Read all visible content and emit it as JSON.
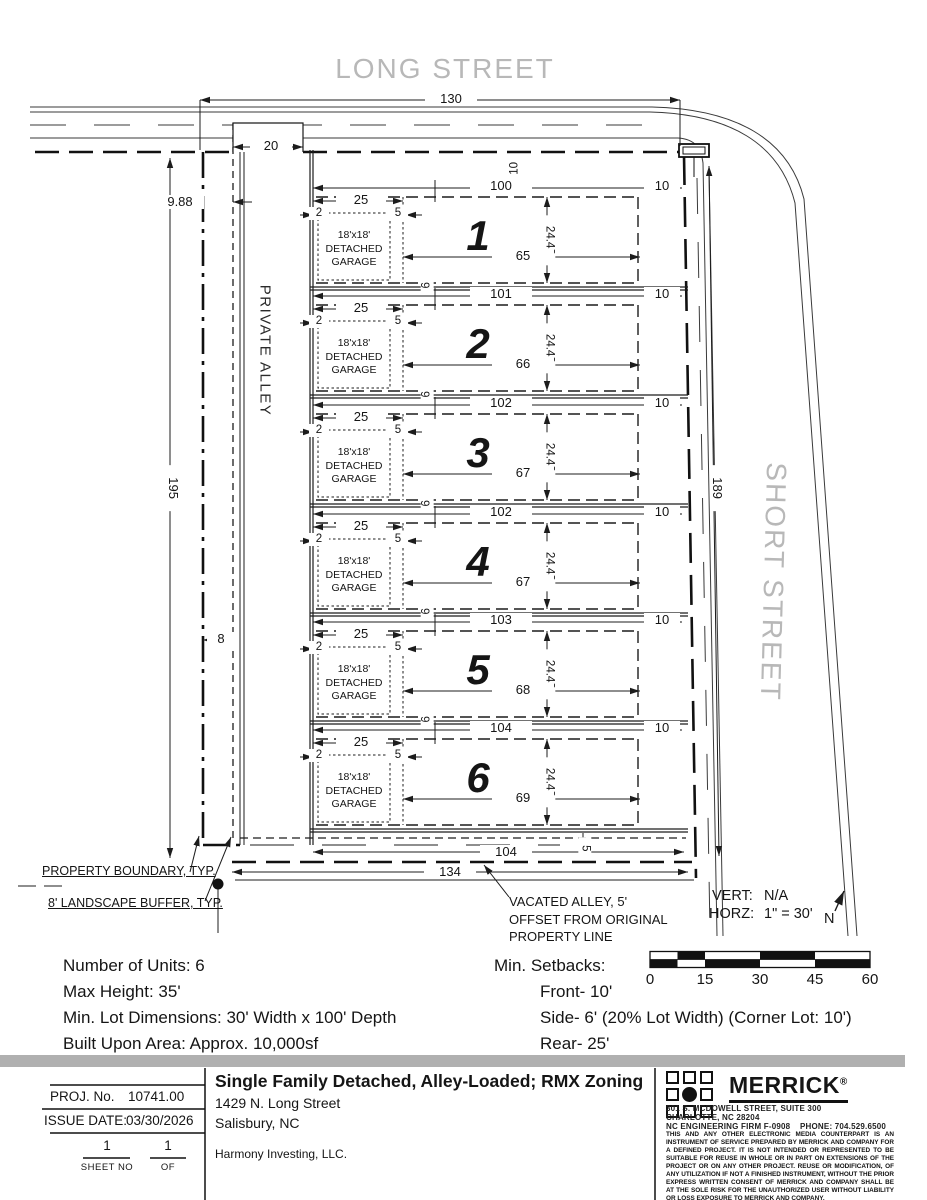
{
  "drawing": {
    "street_top": "LONG STREET",
    "street_right": "SHORT STREET",
    "alley": "PRIVATE ALLEY",
    "dims": {
      "width_top": "130",
      "alley_opening": "20",
      "offset_west": "9.88",
      "depth_west": "195",
      "buffer": "8",
      "depth_east": "189",
      "front_setback": "10",
      "rear_width": "104",
      "alley_offset": "5",
      "width_bottom": "134"
    },
    "lot_common": {
      "front": "25",
      "garage_side": "2",
      "gap": "5",
      "corner": "10",
      "width": "24.43",
      "side": "6",
      "garage1": "18'x18'",
      "garage2": "DETACHED",
      "garage3": "GARAGE"
    },
    "lots": [
      {
        "number": "1",
        "frontage": "100",
        "rear": "65"
      },
      {
        "number": "2",
        "frontage": "101",
        "rear": "66"
      },
      {
        "number": "3",
        "frontage": "102",
        "rear": "67"
      },
      {
        "number": "4",
        "frontage": "102",
        "rear": "67"
      },
      {
        "number": "5",
        "frontage": "103",
        "rear": "68"
      },
      {
        "number": "6",
        "frontage": "104",
        "rear": "69"
      }
    ],
    "callouts": {
      "property_boundary": "PROPERTY BOUNDARY, TYP.",
      "landscape_buffer": "8' LANDSCAPE BUFFER, TYP.",
      "vacated_alley_1": "VACATED ALLEY, 5'",
      "vacated_alley_2": "OFFSET FROM ORIGINAL",
      "vacated_alley_3": "PROPERTY LINE"
    },
    "scale_note": {
      "vert_label": "VERT:",
      "vert_value": "N/A",
      "horz_label": "HORZ:",
      "horz_value": "1\" = 30'",
      "north": "N"
    },
    "scalebar": {
      "t0": "0",
      "t1": "15",
      "t2": "30",
      "t3": "45",
      "t4": "60"
    }
  },
  "notes": {
    "units": "Number of Units: 6",
    "height": "Max Height: 35'",
    "lot_dims": "Min. Lot Dimensions: 30' Width x 100' Depth",
    "built_area": "Built Upon Area: Approx. 10,000sf"
  },
  "setbacks": {
    "title": "Min. Setbacks:",
    "front": "Front- 10'",
    "side": "Side- 6' (20% Lot Width) (Corner Lot: 10')",
    "rear": "Rear- 25'"
  },
  "titleblock": {
    "proj_label": "PROJ. No.",
    "proj_no": "10741.00",
    "issue_label": "ISSUE DATE:",
    "issue_date": "03/30/2026",
    "sheet_no": "1",
    "sheet_label": "SHEET NO",
    "of_no": "1",
    "of_label": "OF",
    "title": "Single Family Detached, Alley-Loaded; RMX Zoning",
    "address1": "1429 N. Long Street",
    "address2": "Salisbury, NC",
    "client": "Harmony Investing, LLC.",
    "firm": {
      "name": "MERRICK",
      "reg": "®",
      "addr1": "301 S. MCDOWELL STREET, SUITE 300",
      "addr2": "CHARLOTTE, NC 28204",
      "firm_no": "NC ENGINEERING FIRM F-0908",
      "phone": "PHONE: 704.529.6500",
      "disclaimer": "THIS AND ANY OTHER ELECTRONIC MEDIA COUNTERPART IS AN INSTRUMENT OF SERVICE PREPARED BY MERRICK AND COMPANY FOR A DEFINED PROJECT. IT IS NOT INTENDED OR REPRESENTED TO BE SUITABLE FOR REUSE IN WHOLE OR IN PART ON EXTENSIONS OF THE PROJECT OR ON ANY OTHER PROJECT. REUSE OR MODIFICATION, OF ANY UTILIZATION IF NOT A FINISHED INSTRUMENT, WITHOUT THE PRIOR EXPRESS WRITTEN CONSENT OF MERRICK AND COMPANY SHALL BE AT THE SOLE RISK FOR THE UNAUTHORIZED USER WITHOUT LIABILITY OR LOSS EXPOSURE TO MERRICK AND COMPANY."
    }
  }
}
